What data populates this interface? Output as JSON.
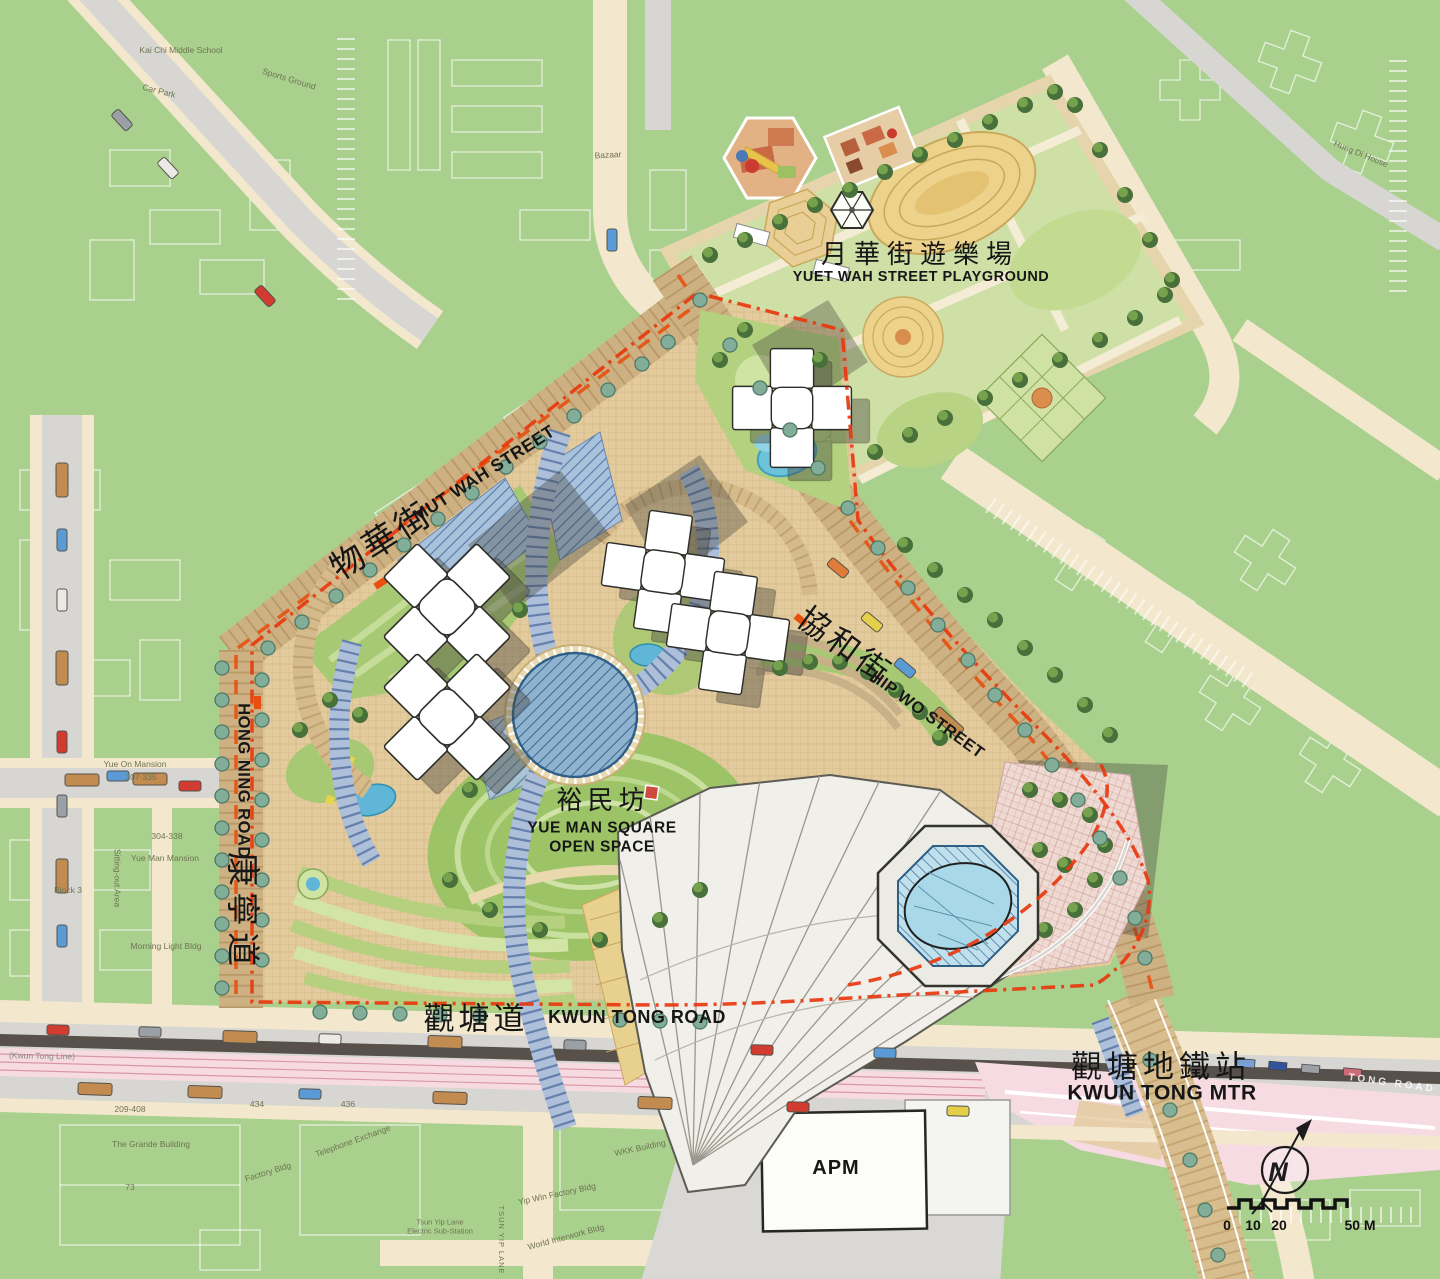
{
  "page": {
    "title": "Kwun Tong Town Centre — Yue Man Square Master Plan"
  },
  "labels": {
    "playground": {
      "zh": "月華街遊樂場",
      "en": "YUET WAH STREET PLAYGROUND"
    },
    "mut_wah_street": {
      "zh": "物華街",
      "en": "MUT WAH STREET"
    },
    "hip_wo_street": {
      "zh": "協和街",
      "en": "HIP WO STREET"
    },
    "hong_ning_road": {
      "zh": "康寧道",
      "en": "HONG NING ROAD"
    },
    "yue_man_square": {
      "zh": "裕民坊",
      "en_line1": "YUE MAN SQUARE",
      "en_line2": "OPEN SPACE"
    },
    "kwun_tong_road": {
      "zh": "觀塘道",
      "en": "KWUN TONG ROAD"
    },
    "kwun_tong_mtr": {
      "zh": "觀塘地鐵站",
      "en": "KWUN TONG MTR"
    },
    "apm": "APM",
    "mtr_line_note": "(Kwun Tong Line)",
    "road_partial_right": "TONG ROAD",
    "bazaar": "Bazaar"
  },
  "bg_labels": [
    "Kai Chi Middle School",
    "Sports Ground",
    "Car Park",
    "Yue On Mansion",
    "307-335",
    "304-338",
    "Yue Man Mansion",
    "Sitting-out Area",
    "Block 3",
    "Morning Light Bldg",
    "The Grande Building",
    "209-408",
    "434",
    "436",
    "73",
    "Factory Bldg",
    "Telephone Exchange",
    "WKK Building",
    "Tsun Yip Lane",
    "Electric Sub-Station",
    "TSUN YIP LANE",
    "Yip Win Factory Bldg",
    "World Interwork Bldg",
    "Hung Di House"
  ],
  "compass": {
    "north": "N"
  },
  "scale_bar": {
    "t0": "0",
    "t10": "10",
    "t20": "20",
    "t50": "50 M"
  },
  "colors": {
    "map_green": "#aad08e",
    "road_cream": "#f3e8cd",
    "road_gray": "#d7d6d2",
    "asphalt_dark": "#57504b",
    "mtr_pink": "#f6dce2",
    "street_brick": "#cdb183",
    "site_paving": "#e3cb9d",
    "boundary_red": "#e8380f",
    "canopy_blue": "#aebfd9",
    "dome_blue": "#8fb3cf",
    "water_blue": "#5fb6d6",
    "lawn_green": "#9cc466",
    "tree_green": "#47703a",
    "tower_white": "#ffffff"
  }
}
